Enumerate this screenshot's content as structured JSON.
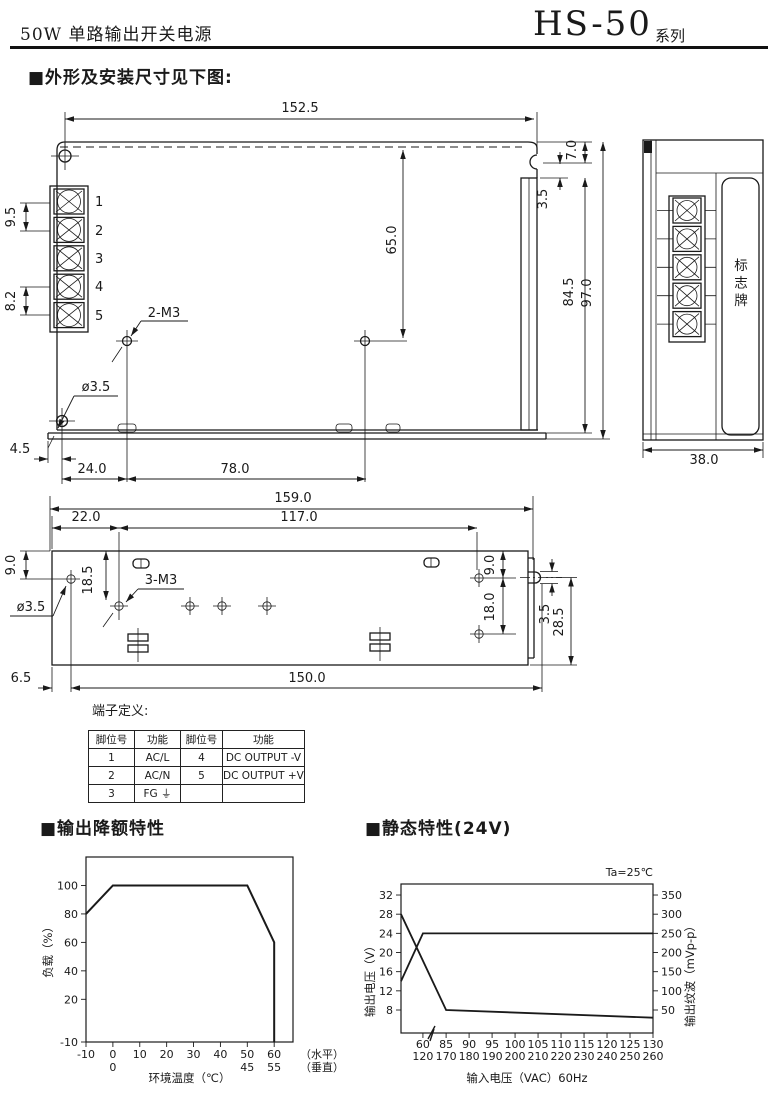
{
  "header": {
    "product": "50W 单路输出开关电源",
    "model": "HS-50",
    "series": "系列"
  },
  "sections": {
    "dim_title": "■外形及安装尺寸见下图:",
    "derating_title": "■输出降额特性",
    "static_title": "■静态特性(24V)"
  },
  "front_view": {
    "dims": {
      "top_width": "152.5",
      "pitch_top": "9.5",
      "pitch_bottom": "8.2",
      "screw_holes": "2-M3",
      "hole_dia": "ø3.5",
      "hole_height": "65.0",
      "corner_offset": "7.0",
      "flange_gap": "3.5",
      "body_height": "84.5",
      "total_height": "97.0",
      "base_indent": "4.5",
      "hole_offset_x": "24.0",
      "hole_pitch_x": "78.0"
    },
    "terminal_numbers": [
      "1",
      "2",
      "3",
      "4",
      "5"
    ]
  },
  "side_view": {
    "width": "38.0",
    "plate_label": "标志牌"
  },
  "bottom_view": {
    "dims": {
      "total_length": "159.0",
      "left_offset": "22.0",
      "hole_span": "117.0",
      "top_margin": "9.0",
      "hole_inset": "18.5",
      "screw_holes": "3-M3",
      "hole_dia": "ø3.5",
      "right_top_margin": "9.0",
      "right_hole_pitch": "18.0",
      "pin_offset": "3.5",
      "pin_depth": "28.5",
      "left_margin": "6.5",
      "base_length": "150.0"
    }
  },
  "terminal_table": {
    "title": "端子定义:",
    "headers": [
      "脚位号",
      "功能",
      "脚位号",
      "功能"
    ],
    "rows": [
      [
        "1",
        "AC/L",
        "4",
        "DC OUTPUT -V"
      ],
      [
        "2",
        "AC/N",
        "5",
        "DC OUTPUT +V"
      ],
      [
        "3",
        "FG ⏚",
        "",
        ""
      ]
    ]
  },
  "chart_data": [
    {
      "type": "line",
      "title": "输出降额特性",
      "xlabel": "环境温度（℃）",
      "ylabel": "负载（%）",
      "x_ticks": [
        -10,
        0,
        10,
        20,
        30,
        40,
        50,
        60
      ],
      "x_ticks_row2": {
        "0": "0",
        "50": "45",
        "60": "55"
      },
      "row_labels": [
        "（水平）",
        "（垂直）"
      ],
      "y_ticks": [
        100,
        80,
        60,
        40,
        20,
        -10
      ],
      "xlim": [
        -10,
        67
      ],
      "ylim": [
        -10,
        120
      ],
      "grid": false,
      "series": [
        {
          "name": "load-vs-ambient-temperature",
          "points": [
            [
              -10,
              80
            ],
            [
              0,
              100
            ],
            [
              50,
              100
            ],
            [
              60,
              60
            ],
            [
              60,
              -10
            ]
          ]
        }
      ]
    },
    {
      "type": "line",
      "title": "静态特性(24V)",
      "annotation": "Ta=25℃",
      "xlabel": "输入电压（VAC）60Hz",
      "ylabel_left": "输出电压（V）",
      "ylabel_right": "输出纹波（mVp-p）",
      "x_ticks_row1": [
        60,
        85,
        90,
        95,
        100,
        105,
        110,
        115,
        120,
        125,
        130
      ],
      "x_ticks_row2": [
        120,
        170,
        180,
        190,
        200,
        210,
        220,
        230,
        240,
        250,
        260
      ],
      "y_ticks_left": [
        32,
        28,
        24,
        20,
        16,
        12,
        8
      ],
      "y_ticks_right": [
        350,
        300,
        250,
        200,
        150,
        100,
        50
      ],
      "x_axis_break": true,
      "grid": false,
      "series": [
        {
          "name": "output-voltage",
          "axis": "left",
          "points": [
            [
              55,
              14
            ],
            [
              60,
              24
            ],
            [
              130,
              24
            ]
          ]
        },
        {
          "name": "output-ripple",
          "axis": "right",
          "points": [
            [
              55,
              300
            ],
            [
              85,
              50
            ],
            [
              130,
              30
            ]
          ]
        }
      ]
    }
  ]
}
